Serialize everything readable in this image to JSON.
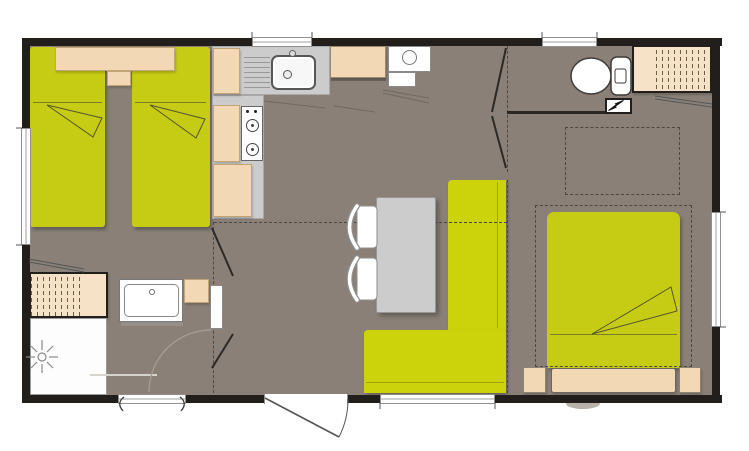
{
  "colors": {
    "page": "#ffffff",
    "wall": "#211e1b",
    "floor": "#8a8078",
    "bed": "#c6cc13",
    "bench": "#cdd30b",
    "beige": "#f2d8b4",
    "beigeLight": "#f6e2c6",
    "counter": "#cccccc",
    "white": "#ffffff",
    "outline": "#5a5750",
    "dash": "#4b4844",
    "textile": "#6e6e2a",
    "doorArc": "#a49b92",
    "shadow": "rgba(0,0,0,0.28)"
  },
  "plan": {
    "type": "mobile-home-floorplan",
    "rooms": [
      "twin-bedroom",
      "kitchen",
      "living-dining",
      "bathroom",
      "wc",
      "double-bedroom"
    ],
    "items": [
      "single-bed",
      "single-bed",
      "twin-headboard",
      "bedside-unit",
      "kitchen-counter",
      "kitchen-sink",
      "gas-hob",
      "fridge",
      "water-heater",
      "dining-table",
      "chair",
      "chair",
      "corner-bench",
      "entrance-door",
      "wardrobe",
      "shower",
      "washbasin",
      "vanity-cabinet",
      "bathroom-door",
      "toilet",
      "cistern",
      "electrical-panel",
      "wardrobe",
      "overhead-storage",
      "double-bed",
      "double-headboard",
      "nightstand",
      "nightstand",
      "window",
      "window",
      "window",
      "window",
      "window",
      "window",
      "step"
    ]
  }
}
